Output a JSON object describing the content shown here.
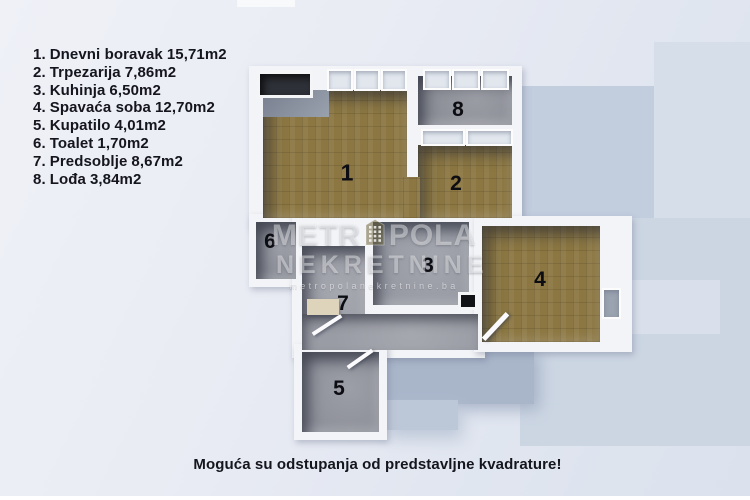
{
  "legend": {
    "items": [
      {
        "num": "1.",
        "name": "Dnevni boravak",
        "area": "15,71m2"
      },
      {
        "num": "2.",
        "name": "Trpezarija",
        "area": "7,86m2"
      },
      {
        "num": "3.",
        "name": "Kuhinja",
        "area": "6,50m2"
      },
      {
        "num": "4.",
        "name": "Spavaća soba",
        "area": "12,70m2"
      },
      {
        "num": "5.",
        "name": "Kupatilo",
        "area": "4,01m2"
      },
      {
        "num": "6.",
        "name": "Toalet",
        "area": "1,70m2"
      },
      {
        "num": "7.",
        "name": "Predsoblje",
        "area": "8,67m2"
      },
      {
        "num": "8.",
        "name": "Lođa",
        "area": "3,84m2"
      }
    ]
  },
  "plan": {
    "room_labels": [
      "1",
      "2",
      "3",
      "4",
      "5",
      "6",
      "7",
      "8"
    ]
  },
  "watermark": {
    "brand_left": "METR",
    "brand_right": "POLA",
    "line2": "NEKRETNINE",
    "url": "metropolanekretnine.ba"
  },
  "disclaimer": "Moguća su odstupanja od predstavljne kvadrature!",
  "colors": {
    "wood_floor": "#8c7742",
    "tile_floor": "#94969f",
    "wall": "#f3f4f7",
    "shadow_blue": "#c2cdde",
    "background": "#eaecf4",
    "text": "#14151d"
  }
}
